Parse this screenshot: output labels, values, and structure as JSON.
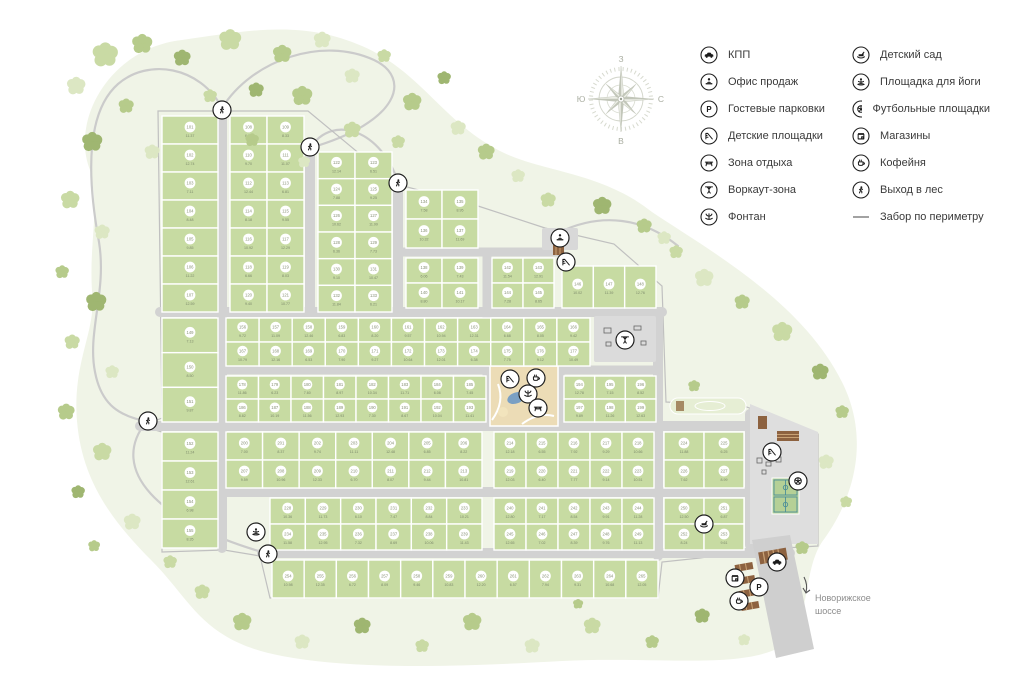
{
  "legend": {
    "columns": [
      [
        {
          "icon": "car",
          "label": "КПП"
        },
        {
          "icon": "sales-office",
          "label": "Офис продаж"
        },
        {
          "icon": "parking",
          "label": "Гостевые парковки"
        },
        {
          "icon": "playground",
          "label": "Детские площадки"
        },
        {
          "icon": "rest-area",
          "label": "Зона отдыха"
        },
        {
          "icon": "workout",
          "label": "Воркаут-зона"
        },
        {
          "icon": "fountain",
          "label": "Фонтан"
        }
      ],
      [
        {
          "icon": "kindergarten",
          "label": "Детский сад"
        },
        {
          "icon": "yoga",
          "label": "Площадка для йоги"
        },
        {
          "icon": "football",
          "label": "Футбольные площадки"
        },
        {
          "icon": "shops",
          "label": "Магазины"
        },
        {
          "icon": "coffee",
          "label": "Кофейня"
        },
        {
          "icon": "forest-exit",
          "label": "Выход в лес"
        },
        {
          "icon": "fence",
          "label": "Забор по периметру"
        }
      ]
    ]
  },
  "compass": {
    "top": "З",
    "right": "С",
    "bottom": "В",
    "left": "Ю"
  },
  "highway": {
    "line1": "Новорижское",
    "line2": "шоссе"
  },
  "colors": {
    "lawn": "#f0f4e7",
    "plot": "#c7dba2",
    "road": "#d2d2d2",
    "park": "#ecdcb6",
    "pond": "#7aa0c4",
    "building": "#8d6240",
    "pitch_lines": "#4d8f99",
    "tree_palette": [
      "#dce7c3",
      "#c9daa4",
      "#b6cb8b",
      "#9fb671",
      "#e3ecd2"
    ]
  },
  "map": {
    "plot_numbering": {
      "start": 101
    },
    "blocks": [
      {
        "x": 162,
        "y": 116,
        "w": 56,
        "h": 196,
        "rows": 7,
        "cols": 1
      },
      {
        "x": 230,
        "y": 116,
        "w": 74,
        "h": 196,
        "rows": 7,
        "cols": 2
      },
      {
        "x": 318,
        "y": 152,
        "w": 74,
        "h": 160,
        "rows": 6,
        "cols": 2
      },
      {
        "x": 406,
        "y": 190,
        "w": 72,
        "h": 58,
        "rows": 2,
        "cols": 2
      },
      {
        "x": 406,
        "y": 258,
        "w": 72,
        "h": 50,
        "rows": 2,
        "cols": 2
      },
      {
        "x": 492,
        "y": 258,
        "w": 62,
        "h": 50,
        "rows": 2,
        "cols": 2
      },
      {
        "x": 562,
        "y": 266,
        "w": 94,
        "h": 42,
        "rows": 1,
        "cols": 3
      },
      {
        "x": 162,
        "y": 318,
        "w": 56,
        "h": 104,
        "rows": 3,
        "cols": 1
      },
      {
        "x": 162,
        "y": 432,
        "w": 56,
        "h": 116,
        "rows": 4,
        "cols": 1
      },
      {
        "x": 226,
        "y": 318,
        "w": 364,
        "h": 48,
        "rows": 2,
        "cols": 11
      },
      {
        "x": 226,
        "y": 376,
        "w": 260,
        "h": 46,
        "rows": 2,
        "cols": 8
      },
      {
        "x": 564,
        "y": 376,
        "w": 92,
        "h": 46,
        "rows": 2,
        "cols": 3
      },
      {
        "x": 226,
        "y": 432,
        "w": 256,
        "h": 56,
        "rows": 2,
        "cols": 7
      },
      {
        "x": 494,
        "y": 432,
        "w": 160,
        "h": 56,
        "rows": 2,
        "cols": 5
      },
      {
        "x": 664,
        "y": 432,
        "w": 80,
        "h": 56,
        "rows": 2,
        "cols": 2
      },
      {
        "x": 270,
        "y": 498,
        "w": 212,
        "h": 52,
        "rows": 2,
        "cols": 6
      },
      {
        "x": 494,
        "y": 498,
        "w": 160,
        "h": 52,
        "rows": 2,
        "cols": 5
      },
      {
        "x": 664,
        "y": 498,
        "w": 80,
        "h": 52,
        "rows": 2,
        "cols": 2
      },
      {
        "x": 272,
        "y": 560,
        "w": 386,
        "h": 38,
        "rows": 1,
        "cols": 12
      }
    ],
    "roads": [
      [
        222,
        113,
        222,
        548,
        10
      ],
      [
        310,
        150,
        310,
        312,
        10
      ],
      [
        398,
        186,
        398,
        312,
        10
      ],
      [
        487,
        252,
        487,
        426,
        9
      ],
      [
        560,
        368,
        560,
        426,
        9
      ],
      [
        658,
        312,
        658,
        556,
        10
      ],
      [
        750,
        414,
        750,
        545,
        10
      ],
      [
        160,
        312,
        662,
        312,
        10
      ],
      [
        224,
        370,
        656,
        370,
        9
      ],
      [
        140,
        426,
        752,
        426,
        10
      ],
      [
        224,
        492,
        758,
        492,
        10
      ],
      [
        262,
        553,
        790,
        553,
        10
      ],
      [
        398,
        252,
        560,
        252,
        9
      ]
    ],
    "trails": [
      "M222,108 C200,66 148,58 118,84 C84,114 88,182 99,242 C107,292 87,332 95,372 C103,414 130,416 146,422",
      "M222,108 C252,60 322,36 374,60 C412,78 400,122 310,148",
      "M398,182 C382,132 334,112 310,148",
      "M146,422 C108,470 158,522 262,552",
      "M560,232 C602,212 644,218 678,246"
    ],
    "fence_path": "M158,111 L308,111 L396,184 L478,206 L545,228 L614,244 L662,286 L666,402 L744,406 L818,434 L818,546 L752,550 L700,558 L662,562 L658,598 L270,598 L260,556 L224,550 L162,552 L162,432 L142,426 L162,418 Z",
    "lawn_path": "M90,170 C70,120 110,48 182,40 C252,30 302,20 362,46 C422,72 442,122 502,152 C542,172 602,172 652,212 C712,252 802,302 842,382 C872,442 852,502 822,542 C802,572 812,622 782,646 C742,670 652,656 562,661 C472,666 362,671 282,656 C202,641 192,601 152,561 C112,521 82,481 77,421 C72,361 97,331 92,291 C89,241 100,212 90,170 Z",
    "trees": [
      [
        105,
        55,
        15,
        1
      ],
      [
        142,
        44,
        12,
        2
      ],
      [
        76,
        86,
        11,
        0
      ],
      [
        182,
        58,
        10,
        3
      ],
      [
        230,
        40,
        13,
        1
      ],
      [
        282,
        54,
        11,
        2
      ],
      [
        322,
        40,
        10,
        0
      ],
      [
        256,
        90,
        9,
        3
      ],
      [
        210,
        96,
        8,
        1
      ],
      [
        302,
        96,
        12,
        2
      ],
      [
        352,
        76,
        9,
        0
      ],
      [
        384,
        56,
        8,
        1
      ],
      [
        126,
        106,
        9,
        2
      ],
      [
        92,
        142,
        12,
        3
      ],
      [
        152,
        152,
        9,
        0
      ],
      [
        252,
        140,
        8,
        2
      ],
      [
        352,
        130,
        10,
        1
      ],
      [
        304,
        162,
        7,
        0
      ],
      [
        412,
        102,
        11,
        2
      ],
      [
        444,
        78,
        8,
        3
      ],
      [
        398,
        142,
        8,
        1
      ],
      [
        458,
        128,
        9,
        0
      ],
      [
        486,
        152,
        10,
        2
      ],
      [
        518,
        176,
        8,
        0
      ],
      [
        548,
        200,
        9,
        1
      ],
      [
        602,
        206,
        11,
        3
      ],
      [
        644,
        226,
        9,
        2
      ],
      [
        676,
        252,
        8,
        1
      ],
      [
        70,
        200,
        11,
        1
      ],
      [
        102,
        232,
        9,
        0
      ],
      [
        62,
        272,
        8,
        2
      ],
      [
        96,
        302,
        12,
        3
      ],
      [
        72,
        342,
        9,
        1
      ],
      [
        112,
        372,
        8,
        0
      ],
      [
        66,
        412,
        10,
        2
      ],
      [
        102,
        452,
        11,
        1
      ],
      [
        78,
        492,
        8,
        3
      ],
      [
        132,
        522,
        10,
        0
      ],
      [
        94,
        546,
        7,
        2
      ],
      [
        170,
        562,
        8,
        1
      ],
      [
        704,
        278,
        11,
        0
      ],
      [
        742,
        302,
        9,
        2
      ],
      [
        782,
        332,
        12,
        1
      ],
      [
        820,
        372,
        10,
        3
      ],
      [
        842,
        412,
        8,
        2
      ],
      [
        826,
        462,
        9,
        0
      ],
      [
        846,
        502,
        7,
        1
      ],
      [
        802,
        548,
        8,
        2
      ],
      [
        664,
        238,
        8,
        0
      ],
      [
        694,
        386,
        7,
        2
      ],
      [
        202,
        592,
        9,
        1
      ],
      [
        242,
        622,
        11,
        2
      ],
      [
        302,
        642,
        9,
        0
      ],
      [
        362,
        626,
        10,
        3
      ],
      [
        422,
        646,
        8,
        1
      ],
      [
        472,
        622,
        11,
        2
      ],
      [
        532,
        646,
        9,
        0
      ],
      [
        592,
        626,
        10,
        1
      ],
      [
        652,
        642,
        8,
        2
      ],
      [
        702,
        616,
        9,
        3
      ],
      [
        744,
        640,
        7,
        0
      ],
      [
        578,
        604,
        6,
        2
      ]
    ],
    "icons": [
      {
        "type": "forest-exit",
        "x": 222,
        "y": 110
      },
      {
        "type": "forest-exit",
        "x": 310,
        "y": 147
      },
      {
        "type": "forest-exit",
        "x": 398,
        "y": 183
      },
      {
        "type": "forest-exit",
        "x": 148,
        "y": 421
      },
      {
        "type": "forest-exit",
        "x": 268,
        "y": 554
      },
      {
        "type": "sales-office",
        "x": 560,
        "y": 238
      },
      {
        "type": "playground",
        "x": 566,
        "y": 262
      },
      {
        "type": "workout",
        "x": 625,
        "y": 340
      },
      {
        "type": "playground",
        "x": 510,
        "y": 379
      },
      {
        "type": "coffee",
        "x": 536,
        "y": 378
      },
      {
        "type": "fountain",
        "x": 528,
        "y": 394
      },
      {
        "type": "rest-area",
        "x": 538,
        "y": 408
      },
      {
        "type": "playground",
        "x": 772,
        "y": 452
      },
      {
        "type": "football",
        "x": 798,
        "y": 481
      },
      {
        "type": "kindergarten",
        "x": 704,
        "y": 524
      },
      {
        "type": "yoga",
        "x": 256,
        "y": 532
      },
      {
        "type": "car",
        "x": 777,
        "y": 562
      },
      {
        "type": "shops",
        "x": 735,
        "y": 578
      },
      {
        "type": "parking",
        "x": 759,
        "y": 587
      },
      {
        "type": "coffee",
        "x": 739,
        "y": 601
      }
    ]
  }
}
